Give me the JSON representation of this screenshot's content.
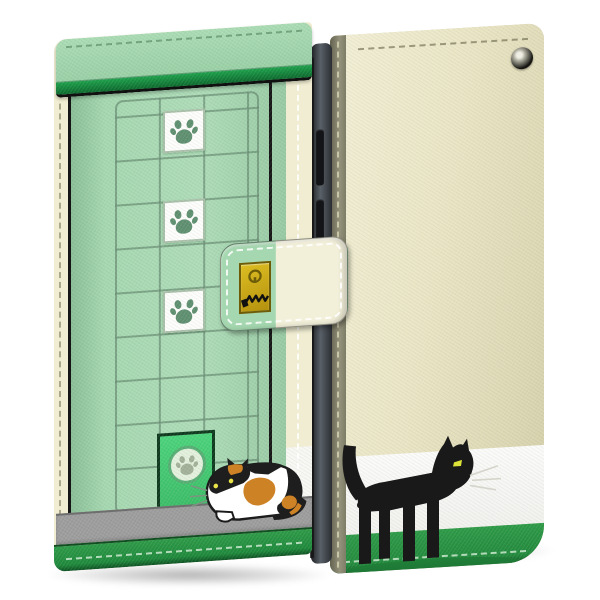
{
  "scene": {
    "type": "product-photo",
    "subject": "wallet-style smartphone flip case with cat theme",
    "views": [
      "front-closed",
      "back"
    ],
    "motifs": [
      "screen-door grid",
      "paw-print windows",
      "cat door",
      "calico cat",
      "black cat",
      "keyhole charm"
    ],
    "paw_window_count": 3
  },
  "colors": {
    "mint": "#a5d8b0",
    "cream": "#f0edd2",
    "backCream": "#e9e5c4",
    "bandGreen": "#2e9b48",
    "trimGreen": "#0d6a2e",
    "doorGreen": "#43c873",
    "sidewalk": "#9d9d9d",
    "gridLine": "rgba(104,140,114,0.7)",
    "gold": "#c9a91c",
    "catOrange": "#cd8226",
    "catBlack": "#1d1d1d",
    "eyeYellow": "#e4e243",
    "pawGreen": "#5f9070",
    "pawGray": "#a2b199",
    "spineKhaki": "#8b8a77",
    "white": "#f7f7f4"
  },
  "icons": {
    "paw": "paw-print-icon",
    "keyhole": "keyhole-icon",
    "zigzag": "zigzag-scribble-icon",
    "eyelet": "strap-eyelet-grommet"
  }
}
